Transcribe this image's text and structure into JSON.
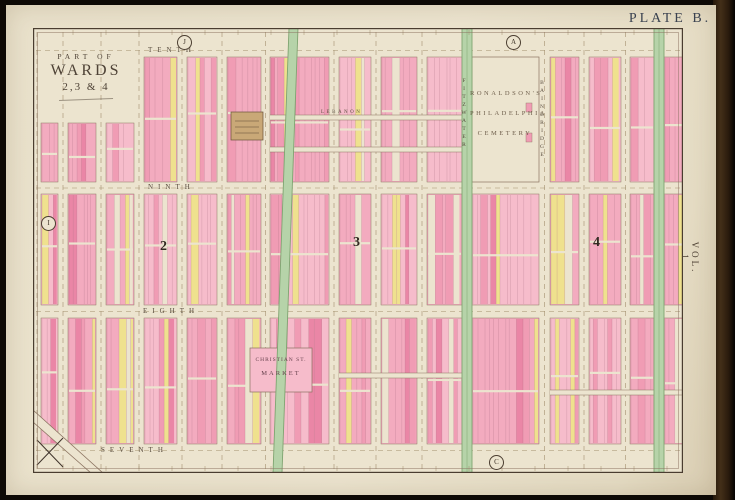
{
  "plate_label": "PLATE B.",
  "volume_label": "VOL. 1",
  "title_block": {
    "line1": "PART OF",
    "line2": "WARDS",
    "line3": "2,3 & 4"
  },
  "streets": {
    "tenth": "TENTH",
    "ninth": "NINTH",
    "eighth": "EIGHTH",
    "seventh": "SEVENTH",
    "fitzwater": "FITZWATER",
    "bainbridge": "BAINBRIDGE",
    "lebanon": "LEBANON"
  },
  "cemetery": {
    "line1": "RONALDSON'S",
    "line2": "PHILADELPHIA",
    "line3": "CEMETERY"
  },
  "market": {
    "line1": "CHRISTIAN ST.",
    "line2": "MARKET"
  },
  "ward_numbers": [
    "2",
    "3",
    "4"
  ],
  "plate_refs": {
    "top_left": "J",
    "top_right": "A",
    "bottom": "C",
    "left": "I"
  },
  "colors": {
    "paper": "#ece4cf",
    "pink1": "#f3abbf",
    "pink2": "#f6bccb",
    "pink3": "#f09cb4",
    "pink_deep": "#ea86a6",
    "yellow": "#efe18e",
    "green": "#b6d3a9",
    "green_line": "#7fa471",
    "line": "#8b7360",
    "lot_line": "rgba(150,95,115,0.45)",
    "dash": "#a2906f",
    "frame": "#4a3d30",
    "school": "#c9a877",
    "ink": "#3f3428"
  },
  "map_grid": {
    "width": 650,
    "height": 445,
    "h_streets": [
      {
        "y": 16,
        "h": 13
      },
      {
        "y": 154,
        "h": 12
      },
      {
        "y": 277,
        "h": 13
      },
      {
        "y": 416,
        "h": 13
      }
    ],
    "v_streets": [
      {
        "x": 0,
        "w": 8
      },
      {
        "x": 25,
        "w": 10
      },
      {
        "x": 63,
        "w": 10
      },
      {
        "x": 101,
        "w": 10
      },
      {
        "x": 144,
        "w": 10
      },
      {
        "x": 184,
        "w": 10
      },
      {
        "x": 228,
        "w": 9
      },
      {
        "x": 296,
        "w": 10
      },
      {
        "x": 338,
        "w": 10
      },
      {
        "x": 384,
        "w": 10
      },
      {
        "x": 506,
        "w": 11
      },
      {
        "x": 546,
        "w": 10
      },
      {
        "x": 588,
        "w": 9
      }
    ],
    "green_streets": [
      {
        "x": 429,
        "w": 10
      },
      {
        "x": 621,
        "w": 10
      }
    ],
    "diagonal_street": {
      "x_top": 256,
      "x_bottom": 240,
      "w": 9
    },
    "minor_streets": [
      {
        "y": 87,
        "h": 5,
        "x1": 237,
        "x2": 429
      },
      {
        "y": 119,
        "h": 5,
        "x1": 237,
        "x2": 429
      },
      {
        "y": 345,
        "h": 5,
        "x1": 306,
        "x2": 429
      },
      {
        "y": 362,
        "h": 5,
        "x1": 517,
        "x2": 650
      }
    ],
    "cemetery_col": 10,
    "school_building": {
      "x": 198,
      "y": 84,
      "w": 32,
      "h": 28
    },
    "market_building": {
      "x": 217,
      "y": 320,
      "w": 62,
      "h": 44
    }
  }
}
